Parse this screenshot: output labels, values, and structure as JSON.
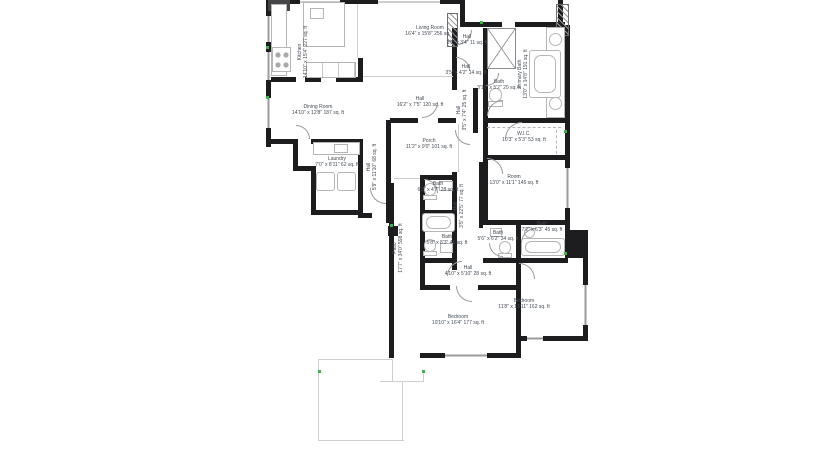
{
  "app": {
    "view": "floor-plan"
  },
  "palette": {
    "background": "#ffffff",
    "wall": "#1d1d1f",
    "label_text": "#434c55",
    "fixture_line": "#b5b5b5",
    "marker_green": "#3cb44a",
    "outline_gray": "#cfcfcf"
  },
  "fixtures": [
    "range-icon",
    "cooktop-icon",
    "kitchen-island",
    "island-sink-icon",
    "laundry-sink-icon",
    "washer-icon",
    "dryer-icon",
    "sink-icon",
    "bathtub-icon",
    "toilet-icon",
    "shower-enclosure-icon",
    "closet-rod",
    "fireplace-hatch",
    "chimney-hatch"
  ],
  "rooms": {
    "kitchen": {
      "name": "Kitchen",
      "dims": "14'10\" x 15'4\" 227 sq. ft"
    },
    "living_room": {
      "name": "Living Room",
      "dims": "16'4\" x 15'8\" 256 sq. ft"
    },
    "dining_room": {
      "name": "Dining Room",
      "dims": "14'10\" x 12'8\" 187 sq. ft"
    },
    "hall_main": {
      "name": "Hall",
      "dims": "16'2\" x 7'5\" 120 sq. ft"
    },
    "hall_top": {
      "name": "Hall",
      "dims": "3'5\" x 3'4\" 11 sq. ft"
    },
    "hall_mid": {
      "name": "Hall",
      "dims": "3'5\" x 4'2\" 14 sq. ft"
    },
    "primary_bath": {
      "name": "Primary Bath",
      "dims": "13'0\" x 14'8\" 191 sq. ft"
    },
    "bath_small": {
      "name": "Bath",
      "dims": "3'10\" x 5'2\" 20 sq. ft"
    },
    "wic": {
      "name": "W.I.C.",
      "dims": "10'3\" x 5'3\" 53 sq. ft"
    },
    "laundry": {
      "name": "Laundry",
      "dims": "7'0\" x 8'11\" 62 sq. ft"
    },
    "hall_laundry": {
      "name": "Hall",
      "dims": "5'9\" x 11'10\" 68 sq. ft"
    },
    "hall_upper": {
      "name": "Hall",
      "dims": "3'5\" x 7'4\" 25 sq. ft"
    },
    "porch": {
      "name": "Porch",
      "dims": "11'2\" x 9'0\" 101 sq. ft"
    },
    "room": {
      "name": "Room",
      "dims": "13'0\" x 11'1\" 145 sq. ft"
    },
    "bath_a": {
      "name": "Bath",
      "dims": "6'2\" x 4'7\" 28 sq. ft"
    },
    "hall_long": {
      "name": "Hall",
      "dims": "3'5\" x 22'5\" 77 sq. ft"
    },
    "bath_b": {
      "name": "Bath",
      "dims": "5'8\" x 8'3\" 46 sq. ft"
    },
    "bath_c": {
      "name": "Bath",
      "dims": "5'6\" x 6'2\" 34 sq. ft"
    },
    "bath_d": {
      "name": "Bath",
      "dims": "7'2\" x 6'3\" 45 sq. ft"
    },
    "hall_bedrooms": {
      "name": "Hall",
      "dims": "4'10\" x 5'10\" 28 sq. ft"
    },
    "patio": {
      "name": "Patio",
      "dims": "17'7\" x 34'0\" 598 sq. ft"
    },
    "bedroom_1": {
      "name": "Bedroom",
      "dims": "10'10\" x 16'4\" 177 sq. ft"
    },
    "bedroom_2": {
      "name": "Bedroom",
      "dims": "11'8\" x 13'11\" 162 sq. ft"
    }
  }
}
